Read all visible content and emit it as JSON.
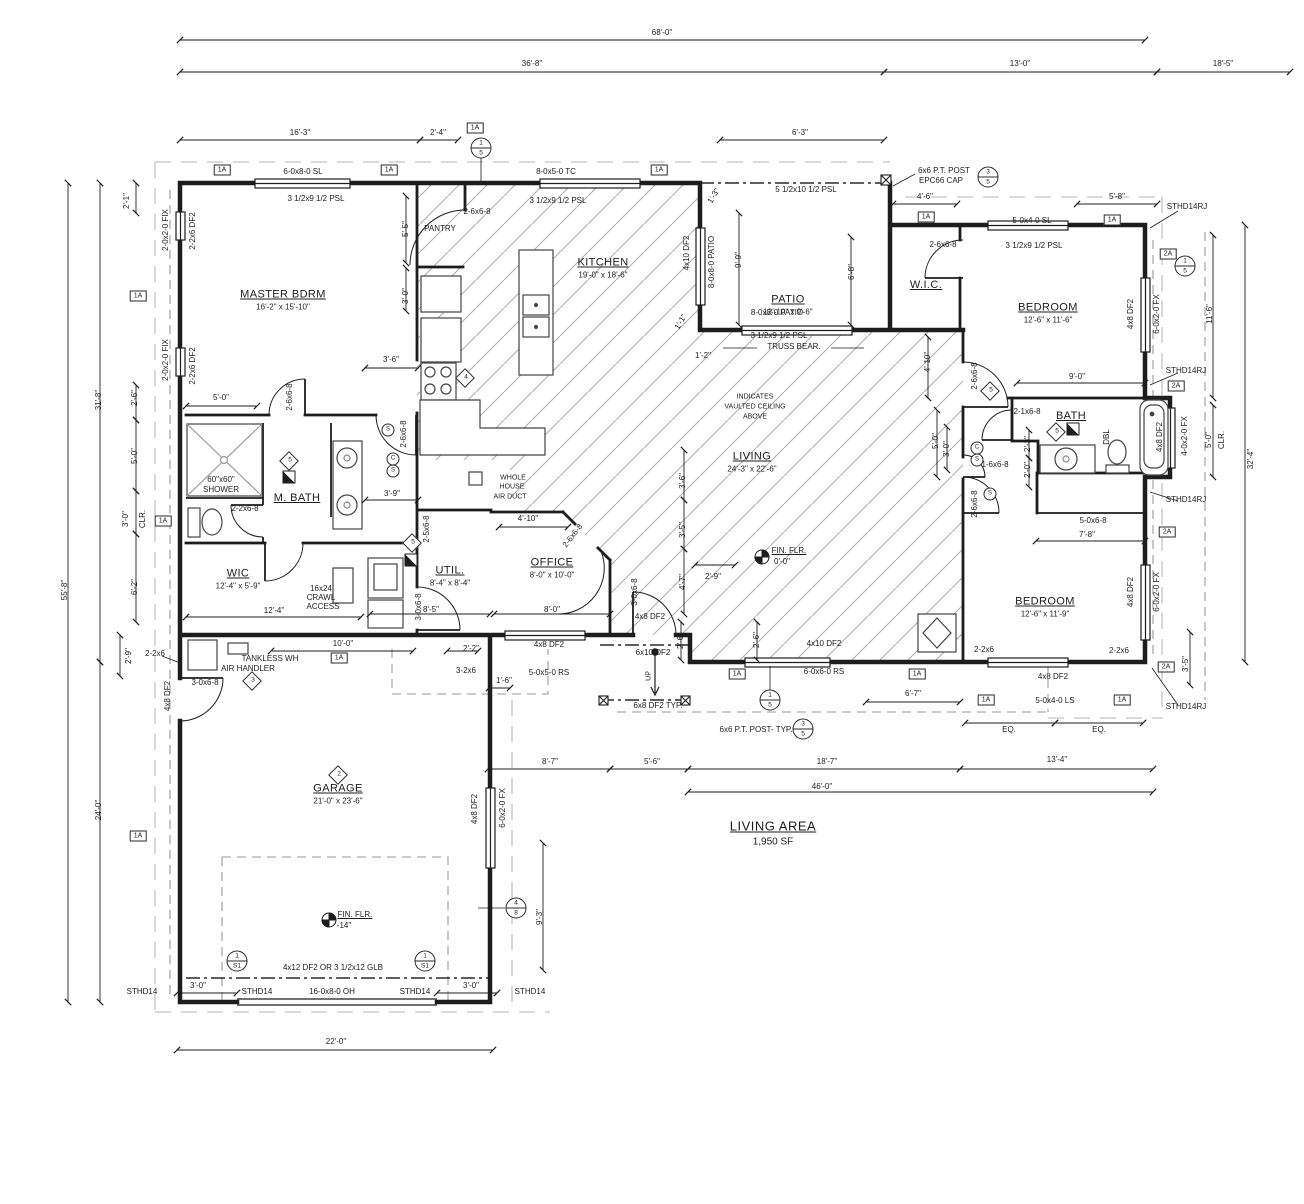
{
  "living_area": {
    "label": "LIVING AREA",
    "value": "1,950 SF",
    "x": 773,
    "y": 833
  },
  "rooms": [
    {
      "name": "MASTER BDRM",
      "dims": "16'-2\" x 15'-10\"",
      "x": 283,
      "y": 300
    },
    {
      "name": "KITCHEN",
      "dims": "19'-0\" x 18'-6\"",
      "x": 603,
      "y": 268
    },
    {
      "name": "PATIO",
      "dims": "12'-10\" x 9'-6\"",
      "x": 788,
      "y": 305
    },
    {
      "name": "W.I.C.",
      "dims": "",
      "x": 926,
      "y": 285
    },
    {
      "name": "BEDROOM",
      "dims": "12'-6\" x 11'-6\"",
      "x": 1048,
      "y": 313
    },
    {
      "name": "BATH",
      "dims": "",
      "x": 1071,
      "y": 416
    },
    {
      "name": "BEDROOM",
      "dims": "12'-6\" x 11'-9\"",
      "x": 1045,
      "y": 607
    },
    {
      "name": "LIVING",
      "dims": "24'-3\" x 22'-6\"",
      "x": 752,
      "y": 462
    },
    {
      "name": "OFFICE",
      "dims": "8'-0\" x 10'-0\"",
      "x": 552,
      "y": 568
    },
    {
      "name": "UTIL.",
      "dims": "8'-4\" x 8'-4\"",
      "x": 450,
      "y": 576
    },
    {
      "name": "M. BATH",
      "dims": "",
      "x": 297,
      "y": 498
    },
    {
      "name": "WIC",
      "dims": "12'-4\" x 5'-9\"",
      "x": 238,
      "y": 579
    },
    {
      "name": "GARAGE",
      "dims": "21'-0\" x 23'-6\"",
      "x": 338,
      "y": 794
    }
  ],
  "labels": [
    {
      "t": "68'-0\"",
      "x": 662,
      "y": 33
    },
    {
      "t": "36'-8\"",
      "x": 532,
      "y": 64
    },
    {
      "t": "13'-0\"",
      "x": 1020,
      "y": 64
    },
    {
      "t": "18'-5\"",
      "x": 1223,
      "y": 64
    },
    {
      "t": "16'-3\"",
      "x": 300,
      "y": 133
    },
    {
      "t": "2'-4\"",
      "x": 438,
      "y": 133
    },
    {
      "t": "6'-3\"",
      "x": 800,
      "y": 133
    },
    {
      "t": "4'-6\"",
      "x": 925,
      "y": 197
    },
    {
      "t": "5'-8\"",
      "x": 1117,
      "y": 197
    },
    {
      "t": "6-0x8-0 SL",
      "x": 303,
      "y": 172
    },
    {
      "t": "3 1/2x9 1/2 PSL",
      "x": 316,
      "y": 199
    },
    {
      "t": "8-0x5-0 TC",
      "x": 556,
      "y": 172
    },
    {
      "t": "3 1/2x9 1/2 PSL",
      "x": 558,
      "y": 201
    },
    {
      "t": "2-6x6-8",
      "x": 477,
      "y": 212
    },
    {
      "t": "PANTRY",
      "x": 440,
      "y": 229
    },
    {
      "t": "5 1/2x10 1/2 PSL",
      "x": 806,
      "y": 190
    },
    {
      "t": "6x6 P.T. POST",
      "x": 944,
      "y": 171
    },
    {
      "t": "EPC66 CAP",
      "x": 941,
      "y": 181
    },
    {
      "t": "5-0x4-0 SL",
      "x": 1032,
      "y": 221
    },
    {
      "t": "3 1/2x9 1/2 PSL",
      "x": 1034,
      "y": 246
    },
    {
      "t": "2-6x6-8",
      "x": 943,
      "y": 245
    },
    {
      "t": "STHD14RJ",
      "x": 1187,
      "y": 207
    },
    {
      "t": "2-0x2-0 FIX",
      "x": 166,
      "y": 230,
      "r": -90
    },
    {
      "t": "2-2x6 DF2",
      "x": 193,
      "y": 231,
      "r": -90
    },
    {
      "t": "2-0x2-0 FIX",
      "x": 166,
      "y": 360,
      "r": -90
    },
    {
      "t": "2-2x6 DF2",
      "x": 193,
      "y": 366,
      "r": -90
    },
    {
      "t": "2'-1\"",
      "x": 127,
      "y": 201,
      "r": -90
    },
    {
      "t": "31'-8\"",
      "x": 99,
      "y": 400,
      "r": -90
    },
    {
      "t": "55'-8\"",
      "x": 65,
      "y": 590,
      "r": -90
    },
    {
      "t": "2'-6\"",
      "x": 135,
      "y": 398,
      "r": -90
    },
    {
      "t": "5'-0\"",
      "x": 135,
      "y": 456,
      "r": -90
    },
    {
      "t": "3'-0\"",
      "x": 126,
      "y": 519,
      "r": -90
    },
    {
      "t": "CLR.",
      "x": 143,
      "y": 519,
      "r": -90
    },
    {
      "t": "6'-2\"",
      "x": 135,
      "y": 587,
      "r": -90
    },
    {
      "t": "2'-9\"",
      "x": 129,
      "y": 656,
      "r": -90
    },
    {
      "t": "24'-0\"",
      "x": 99,
      "y": 810,
      "r": -90
    },
    {
      "t": "5'-5\"",
      "x": 406,
      "y": 229,
      "r": -90
    },
    {
      "t": "3'-0\"",
      "x": 406,
      "y": 296,
      "r": -90
    },
    {
      "t": "3'-6\"",
      "x": 391,
      "y": 360
    },
    {
      "t": "5'-0\"",
      "x": 221,
      "y": 398
    },
    {
      "t": "2-6x6-8",
      "x": 290,
      "y": 397,
      "r": -90
    },
    {
      "t": "2-6x6-8",
      "x": 404,
      "y": 434,
      "r": -90
    },
    {
      "t": "4x10 DF2",
      "x": 687,
      "y": 253,
      "r": -90
    },
    {
      "t": "8-0x8-0 PATIO",
      "x": 712,
      "y": 262,
      "r": -90
    },
    {
      "t": "9'-9\"",
      "x": 739,
      "y": 260,
      "r": -90
    },
    {
      "t": "1'-3\"",
      "x": 714,
      "y": 196,
      "r": -60
    },
    {
      "t": "1'-1\"",
      "x": 681,
      "y": 322,
      "r": -60
    },
    {
      "t": "1'-2\"",
      "x": 703,
      "y": 356
    },
    {
      "t": "8-0x8-0 PATIO",
      "x": 777,
      "y": 313
    },
    {
      "t": "3 1/2x9 1/2 PSL",
      "x": 779,
      "y": 336
    },
    {
      "t": "TRUSS BEAR.",
      "x": 794,
      "y": 347
    },
    {
      "t": "6'-8\"",
      "x": 852,
      "y": 272,
      "r": -90
    },
    {
      "t": "INDICATES",
      "x": 755,
      "y": 397,
      "s": 7
    },
    {
      "t": "VAULTED CEILING",
      "x": 755,
      "y": 407,
      "s": 7
    },
    {
      "t": "ABOVE",
      "x": 755,
      "y": 417,
      "s": 7
    },
    {
      "t": "FIN. FLR.",
      "x": 789,
      "y": 551,
      "u": 1
    },
    {
      "t": "0'-0\"",
      "x": 782,
      "y": 562
    },
    {
      "t": "9'-0\"",
      "x": 1077,
      "y": 377
    },
    {
      "t": "2-6x6-8",
      "x": 975,
      "y": 376,
      "r": -90
    },
    {
      "t": "2-1x6-8",
      "x": 1027,
      "y": 412
    },
    {
      "t": "DBL",
      "x": 1107,
      "y": 437,
      "r": -90
    },
    {
      "t": "2'-3\"",
      "x": 1028,
      "y": 444,
      "r": -90
    },
    {
      "t": "2'-0\"",
      "x": 1028,
      "y": 470,
      "r": -90
    },
    {
      "t": "5-0x6-8",
      "x": 1093,
      "y": 521
    },
    {
      "t": "7'-8\"",
      "x": 1087,
      "y": 535
    },
    {
      "t": "4x8 DF2",
      "x": 1160,
      "y": 437,
      "r": -90
    },
    {
      "t": "4-0x2-0 FX",
      "x": 1185,
      "y": 436,
      "r": -90
    },
    {
      "t": "5'-0\"",
      "x": 1209,
      "y": 440,
      "r": -90
    },
    {
      "t": "CLR.",
      "x": 1222,
      "y": 440,
      "r": -90
    },
    {
      "t": "32'-4\"",
      "x": 1251,
      "y": 459,
      "r": -90
    },
    {
      "t": "STHD14RJ",
      "x": 1186,
      "y": 371
    },
    {
      "t": "STHD14RJ",
      "x": 1186,
      "y": 500
    },
    {
      "t": "STHD14RJ",
      "x": 1186,
      "y": 707
    },
    {
      "t": "4x8 DF2",
      "x": 1131,
      "y": 314,
      "r": -90
    },
    {
      "t": "6-0x2-0 FX",
      "x": 1157,
      "y": 314,
      "r": -90
    },
    {
      "t": "11'-6\"",
      "x": 1210,
      "y": 314,
      "r": -90
    },
    {
      "t": "4x8 DF2",
      "x": 1131,
      "y": 592,
      "r": -90
    },
    {
      "t": "6-0x2-0 FX",
      "x": 1157,
      "y": 592,
      "r": -90
    },
    {
      "t": "3'-5\"",
      "x": 1186,
      "y": 664,
      "r": -90
    },
    {
      "t": "2-2x6",
      "x": 984,
      "y": 650
    },
    {
      "t": "2-2x6",
      "x": 1119,
      "y": 651
    },
    {
      "t": "4x8 DF2",
      "x": 1053,
      "y": 677
    },
    {
      "t": "5-0x4-0 LS",
      "x": 1055,
      "y": 701
    },
    {
      "t": "EQ.",
      "x": 1009,
      "y": 730
    },
    {
      "t": "EQ.",
      "x": 1099,
      "y": 730
    },
    {
      "t": "13'-4\"",
      "x": 1057,
      "y": 760
    },
    {
      "t": "2-6x6-8",
      "x": 975,
      "y": 504,
      "r": -90
    },
    {
      "t": "1-6x6-8",
      "x": 995,
      "y": 465
    },
    {
      "t": "4'-10\"",
      "x": 928,
      "y": 362,
      "r": -90
    },
    {
      "t": "5'-0\"",
      "x": 936,
      "y": 441,
      "r": -90
    },
    {
      "t": "3'-0\"",
      "x": 947,
      "y": 449,
      "r": -90
    },
    {
      "t": "3'-6\"",
      "x": 683,
      "y": 481,
      "r": -90
    },
    {
      "t": "3'-5\"",
      "x": 683,
      "y": 530,
      "r": -90
    },
    {
      "t": "4'-7\"",
      "x": 683,
      "y": 582,
      "r": -90
    },
    {
      "t": "2'-9\"",
      "x": 713,
      "y": 577
    },
    {
      "t": "2'-6\"",
      "x": 681,
      "y": 641,
      "r": -90
    },
    {
      "t": "2'-6\"",
      "x": 757,
      "y": 640,
      "r": -90
    },
    {
      "t": "WHOLE",
      "x": 513,
      "y": 478,
      "s": 7
    },
    {
      "t": "HOUSE",
      "x": 512,
      "y": 487,
      "s": 7
    },
    {
      "t": "AIR DUCT",
      "x": 510,
      "y": 497,
      "s": 7
    },
    {
      "t": "4'-10\"",
      "x": 528,
      "y": 519
    },
    {
      "t": "2-6x6-8",
      "x": 573,
      "y": 536,
      "r": -52
    },
    {
      "t": "3'-9\"",
      "x": 392,
      "y": 494
    },
    {
      "t": "2-2x6-8",
      "x": 245,
      "y": 509
    },
    {
      "t": "2-5x6-8",
      "x": 427,
      "y": 529,
      "r": -90
    },
    {
      "t": "60\"x60\"",
      "x": 221,
      "y": 480
    },
    {
      "t": "SHOWER",
      "x": 221,
      "y": 490
    },
    {
      "t": "16x24",
      "x": 321,
      "y": 589
    },
    {
      "t": "CRAWL",
      "x": 321,
      "y": 598
    },
    {
      "t": "ACCESS",
      "x": 323,
      "y": 607
    },
    {
      "t": "12'-4\"",
      "x": 274,
      "y": 611
    },
    {
      "t": "8'-5\"",
      "x": 431,
      "y": 610
    },
    {
      "t": "3-0x6-8",
      "x": 419,
      "y": 607,
      "r": -90
    },
    {
      "t": "8'-0\"",
      "x": 552,
      "y": 610
    },
    {
      "t": "3-0x6-8",
      "x": 635,
      "y": 592,
      "r": -90
    },
    {
      "t": "4x8 DF2",
      "x": 650,
      "y": 617
    },
    {
      "t": "4x8 DF2",
      "x": 549,
      "y": 645
    },
    {
      "t": "5-0x5-0 RS",
      "x": 549,
      "y": 673
    },
    {
      "t": "2'-2\"",
      "x": 471,
      "y": 649
    },
    {
      "t": "3-2x6",
      "x": 466,
      "y": 671
    },
    {
      "t": "1'-6\"",
      "x": 504,
      "y": 681
    },
    {
      "t": "6x10 DF2",
      "x": 653,
      "y": 653
    },
    {
      "t": "UP",
      "x": 649,
      "y": 676,
      "r": -90,
      "s": 7
    },
    {
      "t": "6x8 DF2 TYP.",
      "x": 658,
      "y": 706
    },
    {
      "t": "6x6 P.T. POST- TYP.",
      "x": 756,
      "y": 730
    },
    {
      "t": "4x10 DF2",
      "x": 824,
      "y": 644
    },
    {
      "t": "6-0x6-0 RS",
      "x": 824,
      "y": 672
    },
    {
      "t": "6'-7\"",
      "x": 913,
      "y": 694
    },
    {
      "t": "8'-7\"",
      "x": 550,
      "y": 762
    },
    {
      "t": "5'-6\"",
      "x": 652,
      "y": 762
    },
    {
      "t": "18'-7\"",
      "x": 827,
      "y": 762
    },
    {
      "t": "46'-0\"",
      "x": 822,
      "y": 787
    },
    {
      "t": "TANKLESS WH",
      "x": 270,
      "y": 659
    },
    {
      "t": "AIR HANDLER",
      "x": 248,
      "y": 669
    },
    {
      "t": "10'-0\"",
      "x": 343,
      "y": 644
    },
    {
      "t": "3-0x6-8",
      "x": 205,
      "y": 683
    },
    {
      "t": "2-2x6",
      "x": 155,
      "y": 654
    },
    {
      "t": "4x8 DF2",
      "x": 168,
      "y": 696,
      "r": -90
    },
    {
      "t": "4x8 DF2",
      "x": 475,
      "y": 809,
      "r": -90
    },
    {
      "t": "6-0x2-0 FX",
      "x": 503,
      "y": 808,
      "r": -90
    },
    {
      "t": "9'-3\"",
      "x": 540,
      "y": 917,
      "r": -90
    },
    {
      "t": "FIN. FLR.",
      "x": 355,
      "y": 915,
      "u": 1
    },
    {
      "t": "-14\"",
      "x": 344,
      "y": 926
    },
    {
      "t": "4x12 DF2 OR 3 1/2x12 GLB",
      "x": 333,
      "y": 968
    },
    {
      "t": "STHD14",
      "x": 142,
      "y": 992
    },
    {
      "t": "STHD14",
      "x": 257,
      "y": 992
    },
    {
      "t": "STHD14",
      "x": 415,
      "y": 992
    },
    {
      "t": "STHD14",
      "x": 530,
      "y": 992
    },
    {
      "t": "3'-0\"",
      "x": 198,
      "y": 986
    },
    {
      "t": "3'-0\"",
      "x": 471,
      "y": 986
    },
    {
      "t": "16-0x8-0 OH",
      "x": 332,
      "y": 992
    },
    {
      "t": "22'-0\"",
      "x": 336,
      "y": 1042
    }
  ],
  "ref_boxes": [
    {
      "t": "1A",
      "x": 222,
      "y": 170
    },
    {
      "t": "1A",
      "x": 389,
      "y": 170
    },
    {
      "t": "1A",
      "x": 475,
      "y": 128
    },
    {
      "t": "1A",
      "x": 659,
      "y": 170
    },
    {
      "t": "1A",
      "x": 926,
      "y": 217
    },
    {
      "t": "1A",
      "x": 1112,
      "y": 220
    },
    {
      "t": "1A",
      "x": 138,
      "y": 296
    },
    {
      "t": "1A",
      "x": 163,
      "y": 521
    },
    {
      "t": "1A",
      "x": 339,
      "y": 658
    },
    {
      "t": "1A",
      "x": 138,
      "y": 836
    },
    {
      "t": "1A",
      "x": 737,
      "y": 674
    },
    {
      "t": "1A",
      "x": 917,
      "y": 674
    },
    {
      "t": "1A",
      "x": 986,
      "y": 700
    },
    {
      "t": "1A",
      "x": 1122,
      "y": 700
    },
    {
      "t": "2A",
      "x": 1168,
      "y": 254
    },
    {
      "t": "2A",
      "x": 1176,
      "y": 386
    },
    {
      "t": "2A",
      "x": 1167,
      "y": 532
    },
    {
      "t": "2A",
      "x": 1166,
      "y": 667
    }
  ],
  "ref_circles": [
    {
      "a": "1",
      "b": "5",
      "x": 481,
      "y": 148
    },
    {
      "a": "3",
      "b": "5",
      "x": 988,
      "y": 177
    },
    {
      "a": "1",
      "b": "5",
      "x": 1185,
      "y": 266
    },
    {
      "a": "1",
      "b": "5",
      "x": 770,
      "y": 700
    },
    {
      "a": "3",
      "b": "5",
      "x": 803,
      "y": 729
    },
    {
      "a": "4",
      "b": "8",
      "x": 516,
      "y": 908
    },
    {
      "a": "1",
      "b": "S1",
      "x": 237,
      "y": 961
    },
    {
      "a": "1",
      "b": "S1",
      "x": 425,
      "y": 961
    }
  ],
  "diamonds": [
    {
      "t": "4",
      "x": 465,
      "y": 378
    },
    {
      "t": "3",
      "x": 252,
      "y": 681
    },
    {
      "t": "2",
      "x": 338,
      "y": 775
    },
    {
      "t": "5",
      "x": 412,
      "y": 543
    },
    {
      "t": "5",
      "x": 289,
      "y": 461
    },
    {
      "t": "5",
      "x": 1056,
      "y": 432
    },
    {
      "t": "5",
      "x": 990,
      "y": 391
    }
  ],
  "elec_symbols": [
    {
      "t": "S",
      "x": 388,
      "y": 430
    },
    {
      "t": "C",
      "x": 393,
      "y": 459
    },
    {
      "t": "S",
      "x": 393,
      "y": 471
    },
    {
      "t": "C",
      "x": 977,
      "y": 448
    },
    {
      "t": "S",
      "x": 977,
      "y": 460
    },
    {
      "t": "S",
      "x": 990,
      "y": 494
    }
  ],
  "half_squares": [
    {
      "x": 289,
      "y": 477
    },
    {
      "x": 411,
      "y": 560
    },
    {
      "x": 1073,
      "y": 429
    }
  ],
  "colors": {
    "line": "#1d1d1d",
    "hatch": "#ababab",
    "overhang": "#c4c4c4",
    "porch_dash": "#9a9a9a"
  }
}
